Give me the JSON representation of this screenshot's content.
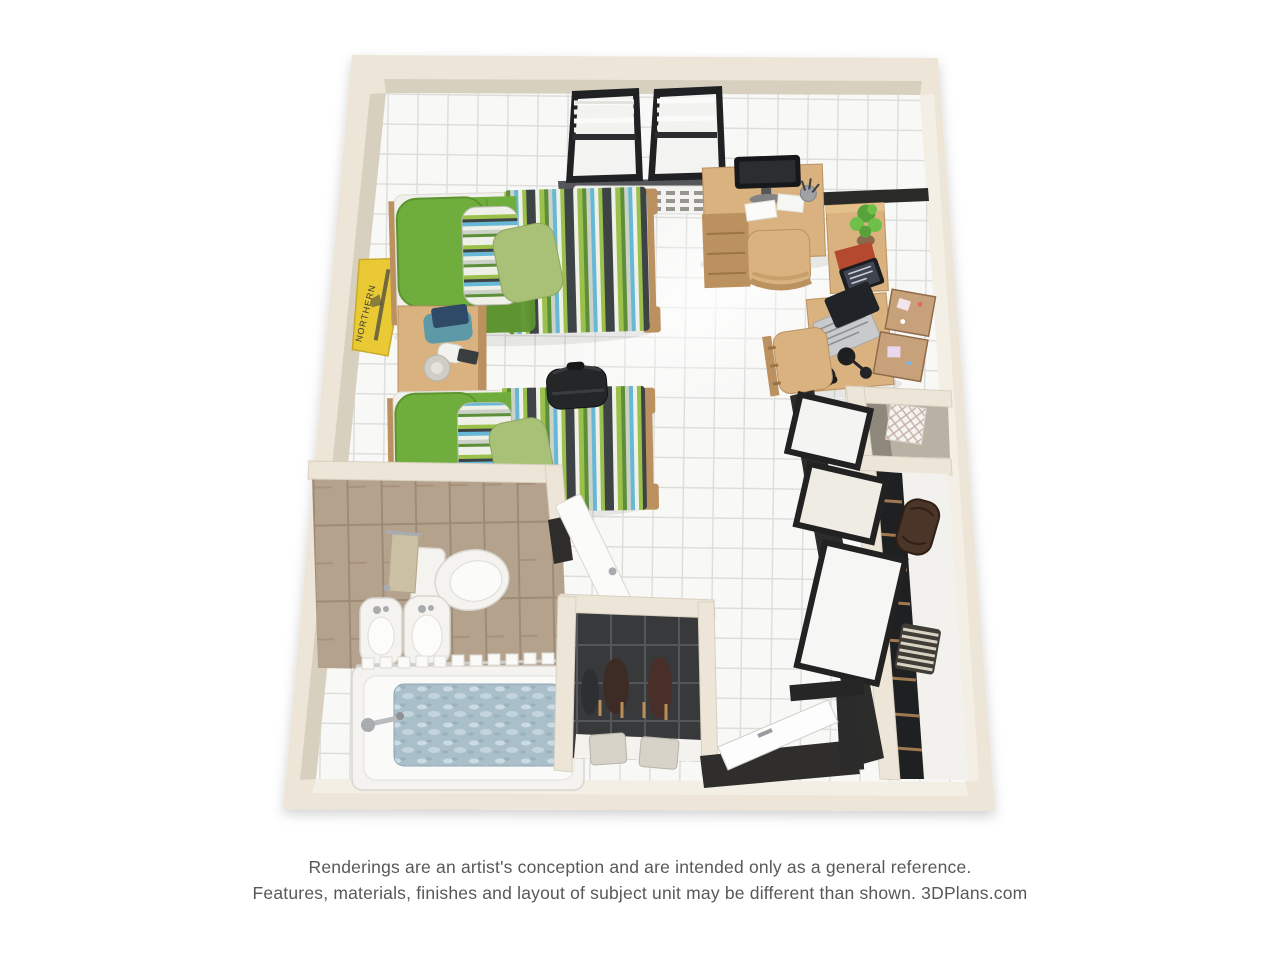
{
  "page": {
    "background": "#ffffff"
  },
  "footer": {
    "line1": "Renderings are an artist's conception and are intended only as a general reference.",
    "line2": "Features, materials, finishes and layout of subject unit may be different than shown. 3DPlans.com"
  },
  "pennant": {
    "text": "NORTHERN"
  },
  "colors": {
    "wall": "#EDE6D8",
    "wall_shadow": "#D8D0BF",
    "wall_light": "#F4EFE4",
    "floor": "#F8F8F7",
    "grout": "#DCDCDA",
    "bath_floor": "#B5A28D",
    "bath_grout": "#9C8B76",
    "wood": "#D9B27F",
    "wood_dark": "#BB915F",
    "green": "#6FAE3C",
    "green_dark": "#5D9430",
    "sage": "#A9C177",
    "stripe_dark": "#3E4346",
    "stripe_blue": "#66B8D6",
    "stripe_lime": "#9CC04C",
    "stripe_gray": "#CDD2C9",
    "stripe_white": "#EFF1E9",
    "white": "#F4F3EF",
    "black": "#26282B",
    "yellow": "#E9CA35",
    "water": "#A9BFCA",
    "teal": "#5E99A8",
    "red": "#B5492F",
    "brown": "#4A3528",
    "cork": "#C7A17A",
    "chrome": "#A9ACAF",
    "text": "#58585A"
  }
}
